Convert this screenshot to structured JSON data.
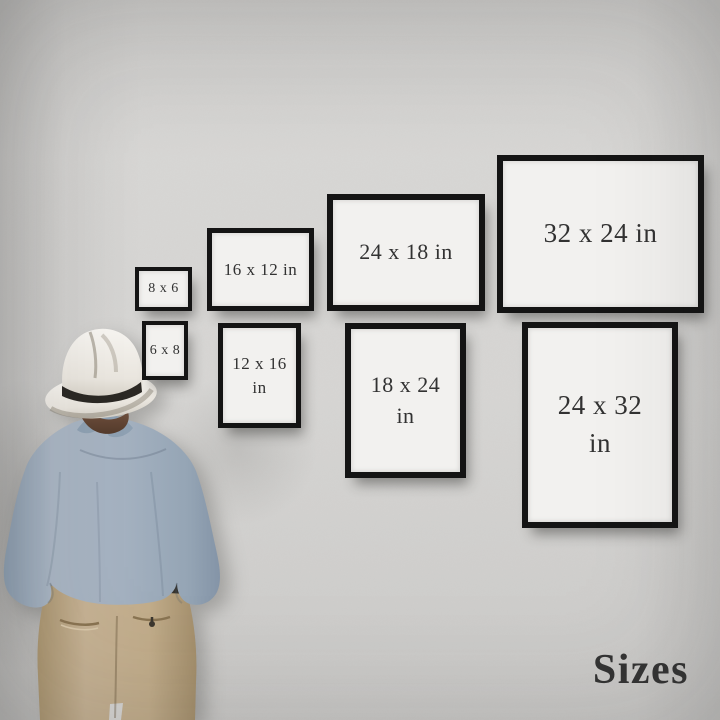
{
  "footer": {
    "title": "Sizes"
  },
  "frames": [
    {
      "id": "8x6",
      "orientation": "landscape",
      "line1": "8 x 6"
    },
    {
      "id": "6x8",
      "orientation": "portrait",
      "line1": "6 x 8"
    },
    {
      "id": "16x12",
      "orientation": "landscape",
      "line1": "16 x 12 in"
    },
    {
      "id": "12x16",
      "orientation": "portrait",
      "line1": "12 x 16",
      "line2": "in"
    },
    {
      "id": "24x18",
      "orientation": "landscape",
      "line1": "24 x 18 in"
    },
    {
      "id": "18x24",
      "orientation": "portrait",
      "line1": "18 x 24",
      "line2": "in"
    },
    {
      "id": "32x24",
      "orientation": "landscape",
      "line1": "32 x 24 in"
    },
    {
      "id": "24x32",
      "orientation": "portrait",
      "line1": "24 x 32",
      "line2": "in"
    }
  ],
  "colors": {
    "wall": "#d2d1cf",
    "frame_border": "#141414",
    "frame_face": "#f2f1ef",
    "frame_text": "#323232",
    "title_text": "#343434",
    "hat": "#efece7",
    "hat_band": "#2b2824",
    "hair": "#6b4a38",
    "shirt": "#a6b2c1",
    "pants": "#c2ad8b"
  }
}
